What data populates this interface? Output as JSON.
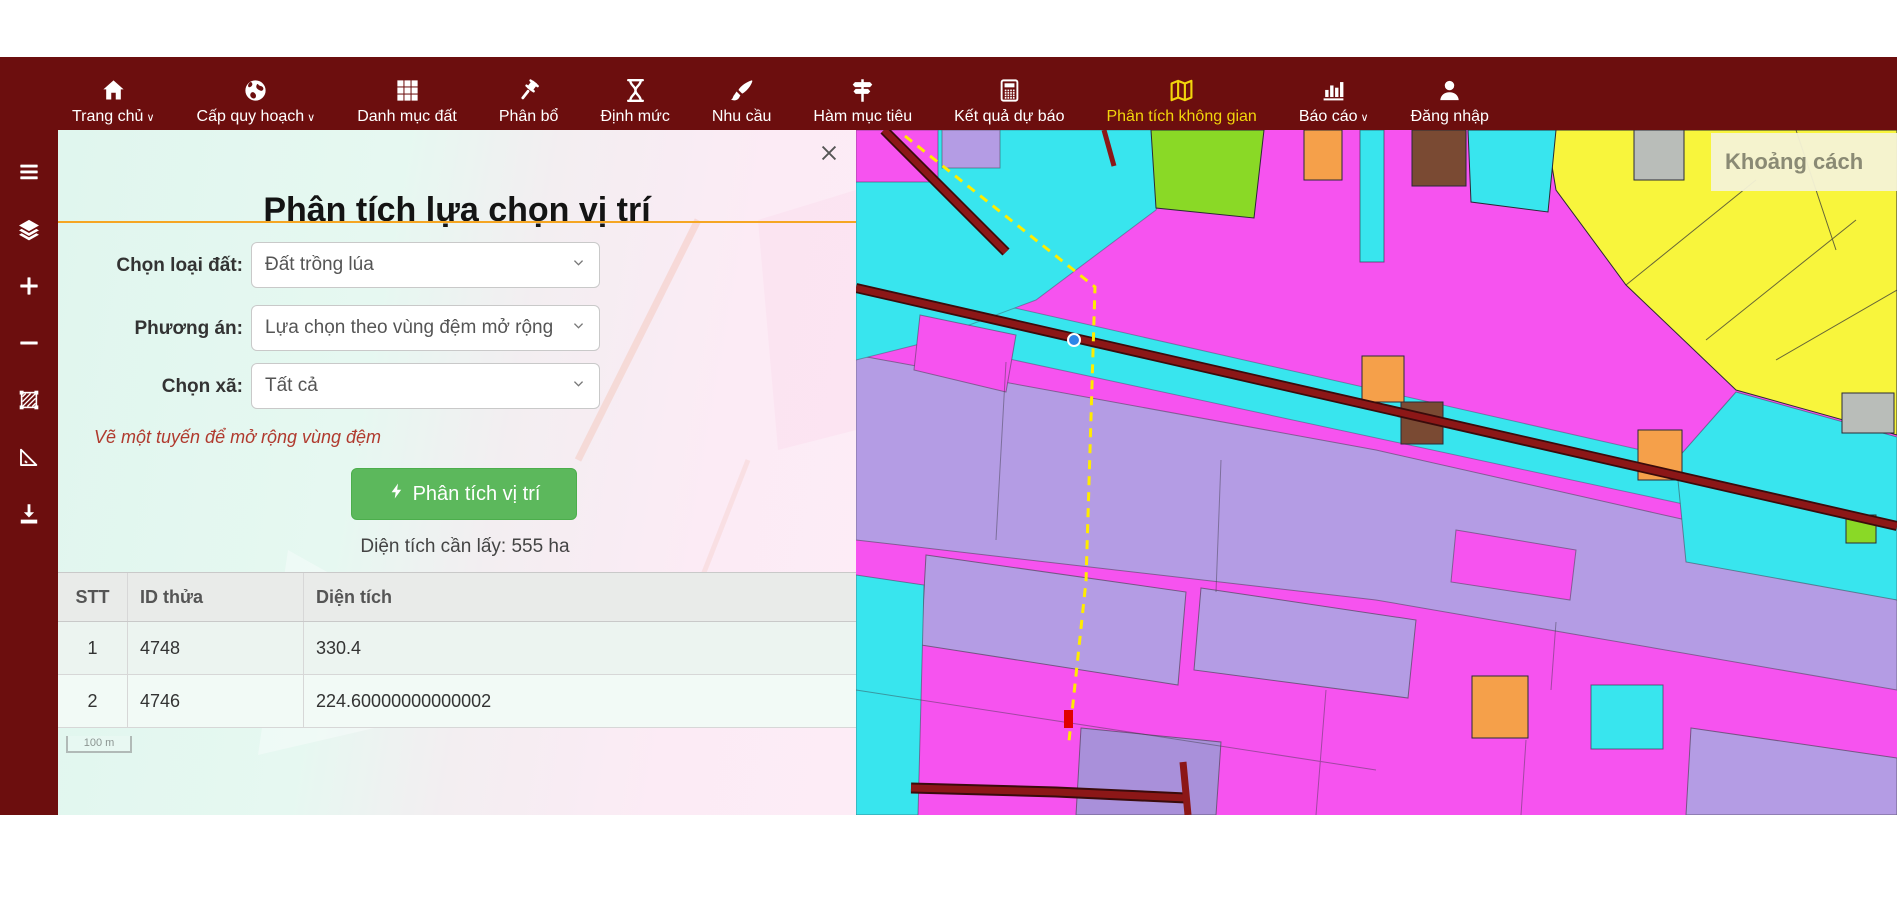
{
  "nav": {
    "items": [
      {
        "name": "home",
        "label": "Trang chủ",
        "icon": "house",
        "caret": true,
        "active": false
      },
      {
        "name": "planning-level",
        "label": "Cấp quy hoạch",
        "icon": "globe",
        "caret": true,
        "active": false
      },
      {
        "name": "land-category",
        "label": "Danh mục đất",
        "icon": "grid",
        "caret": false,
        "active": false
      },
      {
        "name": "allocation",
        "label": "Phân bổ",
        "icon": "gavel",
        "caret": false,
        "active": false
      },
      {
        "name": "norms",
        "label": "Định mức",
        "icon": "hourglass",
        "caret": false,
        "active": false
      },
      {
        "name": "demand",
        "label": "Nhu cầu",
        "icon": "brush",
        "caret": false,
        "active": false
      },
      {
        "name": "objective-function",
        "label": "Hàm mục tiêu",
        "icon": "signpost",
        "caret": false,
        "active": false
      },
      {
        "name": "forecast-results",
        "label": "Kết quả dự báo",
        "icon": "calculator",
        "caret": false,
        "active": false
      },
      {
        "name": "spatial-analysis",
        "label": "Phân tích không gian",
        "icon": "map",
        "caret": false,
        "active": true
      },
      {
        "name": "reports",
        "label": "Báo cáo",
        "icon": "bar-chart",
        "caret": true,
        "active": false
      },
      {
        "name": "login",
        "label": "Đăng nhập",
        "icon": "person",
        "caret": false,
        "active": false
      }
    ]
  },
  "sidebar": {
    "icons": [
      "filter",
      "menu",
      "layers",
      "zoom-in",
      "zoom-out",
      "draw-area",
      "measure",
      "download"
    ]
  },
  "panel": {
    "title": "Phân tích lựa chọn vị trí",
    "fields": [
      {
        "name": "land-type",
        "label": "Chọn loại đất:",
        "value": "Đất trồng lúa"
      },
      {
        "name": "method",
        "label": "Phương án:",
        "value": "Lựa chọn theo vùng đệm mở rộng"
      },
      {
        "name": "commune",
        "label": "Chọn xã:",
        "value": "Tất cả"
      }
    ],
    "note": "Vẽ một tuyến để mở rộng vùng đệm",
    "analyze_button": "Phân tích vị trí",
    "area_text": "Diện tích cần lấy: 555 ha",
    "table": {
      "headers": [
        "STT",
        "ID thửa",
        "Diện tích"
      ],
      "rows": [
        [
          "1",
          "4748",
          "330.4"
        ],
        [
          "2",
          "4746",
          "224.60000000000002"
        ]
      ]
    },
    "scale_label": "100 m"
  },
  "map": {
    "distance_label": "Khoảng cách"
  },
  "colors": {
    "nav_bg": "#6c0e0e",
    "active_nav": "#f2d50c",
    "accent_orange": "#f5a623",
    "button_green": "#5cb85c",
    "note_red": "#b03a2e",
    "map_magenta": "#f653ef",
    "map_cyan": "#38e5ee",
    "map_lavender": "#b49ce4",
    "map_yellow": "#f8f53c",
    "road_red": "#8c1717",
    "measure_yellow": "#ffec00"
  }
}
